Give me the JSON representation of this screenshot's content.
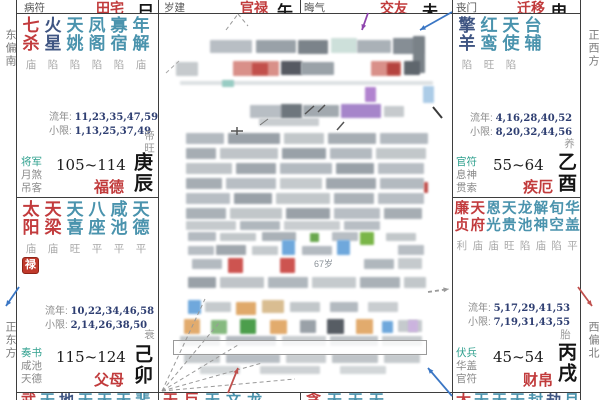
{
  "margins": {
    "left_top": "东偏南",
    "left_bottom": "正东方",
    "right_top": "正西方",
    "right_bottom": "西偏北"
  },
  "top_row": [
    {
      "god": "病符",
      "palace": "田宅",
      "branch": "巳"
    },
    {
      "god": "岁建",
      "palace": "官禄",
      "branch": "午"
    },
    {
      "god": "晦气",
      "palace": "交友",
      "branch": "未"
    },
    {
      "god": "丧门",
      "palace": "迁移",
      "branch": "申"
    }
  ],
  "palaces": {
    "fude": {
      "stars": [
        {
          "name": "七杀",
          "status": "庙",
          "type": "major"
        },
        {
          "name": "火星",
          "status": "陷",
          "type": "malefic"
        },
        {
          "name": "天姚",
          "status": "陷",
          "type": "minor"
        },
        {
          "name": "凤阁",
          "status": "陷",
          "type": "minor"
        },
        {
          "name": "寡宿",
          "status": "陷",
          "type": "minor"
        },
        {
          "name": "年解",
          "status": "庙",
          "type": "minor"
        }
      ],
      "liunian_label": "流年:",
      "liunian": "11,23,35,47,59",
      "xiaoxian_label": "小限:",
      "xiaoxian": "1,13,25,37,49",
      "stage": "帝旺",
      "gods": [
        "将军",
        "月煞",
        "吊客"
      ],
      "age_range": "105~114",
      "palace": "福德",
      "ganzhi": "庚辰"
    },
    "fumu": {
      "stars": [
        {
          "name": "太阳",
          "status": "庙",
          "type": "major"
        },
        {
          "name": "天梁",
          "status": "庙",
          "type": "major"
        },
        {
          "name": "天喜",
          "status": "旺",
          "type": "minor"
        },
        {
          "name": "八座",
          "status": "平",
          "type": "minor"
        },
        {
          "name": "咸池",
          "status": "平",
          "type": "minor"
        },
        {
          "name": "天德",
          "status": "平",
          "type": "minor"
        }
      ],
      "badge": "禄",
      "liunian_label": "流年:",
      "liunian": "10,22,34,46,58",
      "xiaoxian_label": "小限:",
      "xiaoxian": "2,14,26,38,50",
      "stage": "衰",
      "gods": [
        "奏书",
        "咸池",
        "天德"
      ],
      "age_range": "115~124",
      "palace": "父母",
      "ganzhi": "己卯"
    },
    "jie": {
      "stars": [
        {
          "name": "擎羊",
          "status": "陷",
          "type": "malefic"
        },
        {
          "name": "红鸾",
          "status": "旺",
          "type": "minor"
        },
        {
          "name": "天使",
          "status": "陷",
          "type": "minor"
        },
        {
          "name": "台辅",
          "status": "",
          "type": "minor"
        }
      ],
      "liunian_label": "流年:",
      "liunian": "4,16,28,40,52",
      "xiaoxian_label": "小限:",
      "xiaoxian": "8,20,32,44,56",
      "stage": "养",
      "gods": [
        "官符",
        "息神",
        "贯索"
      ],
      "age_range": "55~64",
      "palace": "疾厄",
      "ganzhi": "乙酉"
    },
    "caibo": {
      "stars": [
        {
          "name": "廉贞",
          "status": "利",
          "type": "major"
        },
        {
          "name": "天府",
          "status": "庙",
          "type": "major"
        },
        {
          "name": "恩光",
          "status": "庙",
          "type": "minor"
        },
        {
          "name": "天贵",
          "status": "旺",
          "type": "minor"
        },
        {
          "name": "龙池",
          "status": "陷",
          "type": "minor"
        },
        {
          "name": "解神",
          "status": "庙",
          "type": "minor"
        },
        {
          "name": "旬空",
          "status": "陷",
          "type": "minor"
        },
        {
          "name": "华盖",
          "status": "平",
          "type": "minor"
        }
      ],
      "liunian_label": "流年:",
      "liunian": "5,17,29,41,53",
      "xiaoxian_label": "小限:",
      "xiaoxian": "7,19,31,43,55",
      "stage": "胎",
      "gods": [
        "伏兵",
        "华盖",
        "官符"
      ],
      "age_range": "45~54",
      "palace": "财帛",
      "ganzhi": "丙戌"
    }
  },
  "bottom_row": [
    {
      "chars": [
        [
          "武",
          "major"
        ],
        [
          "天",
          "minor"
        ],
        [
          "地",
          "malefic"
        ],
        [
          "天",
          "minor"
        ],
        [
          "天",
          "minor"
        ],
        [
          "天",
          "minor"
        ],
        [
          "蜚",
          "minor"
        ]
      ]
    },
    {
      "chars": [
        [
          "天",
          "major"
        ],
        [
          "巨",
          "major"
        ],
        [
          "天",
          "minor"
        ],
        [
          "文",
          "minor"
        ],
        [
          "龙",
          "minor"
        ]
      ]
    },
    {
      "chars": [
        [
          "贪",
          "major"
        ],
        [
          "天",
          "minor"
        ],
        [
          "天",
          "minor"
        ],
        [
          "天",
          "minor"
        ]
      ]
    },
    {
      "chars": [
        [
          "太",
          "major"
        ],
        [
          "天",
          "minor"
        ],
        [
          "天",
          "minor"
        ],
        [
          "天",
          "minor"
        ],
        [
          "封",
          "minor"
        ],
        [
          "劫",
          "malefic"
        ],
        [
          "月",
          "minor"
        ]
      ]
    }
  ],
  "colors": {
    "major": "#c23b3d",
    "malefic": "#3f5582",
    "minor": "#4a93ad",
    "status": "#a8a8a8",
    "palace_name": "#c13b3c",
    "badge_bg": "#c0392b",
    "arrow_blue": "#3a76c4",
    "arrow_red": "#c0504d",
    "arrow_purple": "#8e44ad"
  },
  "center": {
    "texts": [
      {
        "x": 314,
        "y": 257,
        "t": "67岁"
      }
    ],
    "outline_box": {
      "x": 173,
      "y": 340,
      "w": 252,
      "h": 13
    },
    "blocks": [
      [
        210,
        40,
        42,
        13,
        "#b8bec4"
      ],
      [
        256,
        40,
        40,
        13,
        "#99a1a8"
      ],
      [
        298,
        40,
        30,
        14,
        "#7b838a"
      ],
      [
        331,
        38,
        26,
        15,
        "#cde0da"
      ],
      [
        357,
        40,
        34,
        13,
        "#aab1b7"
      ],
      [
        393,
        38,
        30,
        16,
        "#868e95"
      ],
      [
        413,
        36,
        12,
        37,
        "#7a8288"
      ],
      [
        176,
        62,
        22,
        14,
        "#c6cacd"
      ],
      [
        233,
        61,
        46,
        15,
        "#d99089"
      ],
      [
        252,
        63,
        16,
        12,
        "#c2504b"
      ],
      [
        281,
        61,
        21,
        14,
        "#565a62"
      ],
      [
        301,
        62,
        33,
        13,
        "#9aa2a8"
      ],
      [
        371,
        61,
        30,
        15,
        "#d99089"
      ],
      [
        387,
        63,
        13,
        12,
        "#b5443f"
      ],
      [
        404,
        61,
        16,
        14,
        "#5f666d"
      ],
      [
        180,
        81,
        253,
        4,
        "#dde1e3"
      ],
      [
        222,
        80,
        12,
        7,
        "#98ccc3"
      ],
      [
        365,
        87,
        11,
        15,
        "#b183cf"
      ],
      [
        423,
        86,
        11,
        17,
        "#accce7"
      ],
      [
        250,
        105,
        32,
        13,
        "#b8bec4"
      ],
      [
        281,
        104,
        21,
        15,
        "#6e767d"
      ],
      [
        303,
        105,
        36,
        12,
        "#a2a9af"
      ],
      [
        341,
        104,
        40,
        14,
        "#a685ca"
      ],
      [
        384,
        106,
        20,
        11,
        "#c6cacd"
      ],
      [
        259,
        118,
        60,
        8,
        "#c9cdd0"
      ],
      [
        186,
        133,
        38,
        11,
        "#b3bac0"
      ],
      [
        228,
        133,
        52,
        11,
        "#9aa1a8"
      ],
      [
        284,
        133,
        40,
        11,
        "#c2c7ca"
      ],
      [
        328,
        133,
        48,
        11,
        "#a6adb3"
      ],
      [
        380,
        133,
        48,
        11,
        "#b3bac0"
      ],
      [
        186,
        148,
        30,
        11,
        "#a6adb3"
      ],
      [
        220,
        148,
        58,
        11,
        "#bfc4c8"
      ],
      [
        282,
        148,
        44,
        11,
        "#99a1a8"
      ],
      [
        330,
        148,
        42,
        11,
        "#b3bac0"
      ],
      [
        376,
        148,
        50,
        11,
        "#c2c7ca"
      ],
      [
        186,
        163,
        46,
        11,
        "#bfc4c8"
      ],
      [
        236,
        163,
        40,
        11,
        "#a0a7ae"
      ],
      [
        280,
        163,
        52,
        11,
        "#b3bac0"
      ],
      [
        336,
        163,
        38,
        11,
        "#99a1a8"
      ],
      [
        378,
        163,
        46,
        11,
        "#b8bec4"
      ],
      [
        186,
        178,
        36,
        11,
        "#a6adb3"
      ],
      [
        226,
        178,
        50,
        11,
        "#b8bec4"
      ],
      [
        280,
        178,
        42,
        11,
        "#c5cacd"
      ],
      [
        326,
        178,
        50,
        11,
        "#a0a7ae"
      ],
      [
        380,
        178,
        44,
        11,
        "#b3bac0"
      ],
      [
        186,
        193,
        44,
        11,
        "#b8bec4"
      ],
      [
        234,
        193,
        38,
        11,
        "#9aa1a8"
      ],
      [
        276,
        193,
        54,
        11,
        "#c2c7ca"
      ],
      [
        334,
        193,
        40,
        11,
        "#abb2b8"
      ],
      [
        378,
        193,
        46,
        11,
        "#b8bec4"
      ],
      [
        186,
        208,
        40,
        11,
        "#aab1b7"
      ],
      [
        230,
        208,
        52,
        11,
        "#c2c7ca"
      ],
      [
        286,
        208,
        44,
        11,
        "#9aa1a8"
      ],
      [
        334,
        208,
        46,
        11,
        "#b8bec4"
      ],
      [
        384,
        208,
        38,
        11,
        "#a6adb3"
      ],
      [
        186,
        221,
        50,
        9,
        "#c5cacd"
      ],
      [
        240,
        221,
        40,
        9,
        "#b0b7bd"
      ],
      [
        284,
        221,
        56,
        9,
        "#c9cdd0"
      ],
      [
        344,
        221,
        36,
        9,
        "#b8bec4"
      ],
      [
        188,
        232,
        28,
        9,
        "#b3bac0"
      ],
      [
        220,
        233,
        36,
        8,
        "#c2c7ca"
      ],
      [
        262,
        232,
        34,
        9,
        "#aab1b7"
      ],
      [
        310,
        233,
        9,
        9,
        "#6aa84f"
      ],
      [
        332,
        232,
        26,
        9,
        "#b8bec4"
      ],
      [
        360,
        232,
        14,
        13,
        "#7ab648"
      ],
      [
        386,
        233,
        30,
        8,
        "#c2c7ca"
      ],
      [
        282,
        240,
        13,
        15,
        "#6fa8dc"
      ],
      [
        337,
        240,
        13,
        15,
        "#6fa8dc"
      ],
      [
        188,
        246,
        26,
        9,
        "#b8bec4"
      ],
      [
        216,
        245,
        30,
        10,
        "#a0a7ae"
      ],
      [
        252,
        246,
        26,
        9,
        "#c5cacd"
      ],
      [
        302,
        246,
        30,
        9,
        "#b3bac0"
      ],
      [
        398,
        245,
        26,
        10,
        "#b8bec4"
      ],
      [
        228,
        258,
        15,
        15,
        "#cd5450"
      ],
      [
        280,
        258,
        15,
        15,
        "#cd5450"
      ],
      [
        192,
        259,
        30,
        10,
        "#b3bac0"
      ],
      [
        364,
        259,
        30,
        10,
        "#b0b7bd"
      ],
      [
        398,
        258,
        24,
        11,
        "#c5cacd"
      ],
      [
        188,
        277,
        28,
        11,
        "#9aa1a8"
      ],
      [
        220,
        277,
        44,
        11,
        "#bfc4c8"
      ],
      [
        268,
        277,
        40,
        11,
        "#b0b7bd"
      ],
      [
        312,
        277,
        44,
        11,
        "#c5cacd"
      ],
      [
        360,
        277,
        40,
        11,
        "#aab1b7"
      ],
      [
        404,
        277,
        22,
        11,
        "#c2c7ca"
      ],
      [
        188,
        300,
        13,
        14,
        "#6fa8dc"
      ],
      [
        236,
        302,
        20,
        13,
        "#e0a96a"
      ],
      [
        262,
        300,
        22,
        13,
        "#d9bd91"
      ],
      [
        205,
        302,
        26,
        10,
        "#c5cacd"
      ],
      [
        290,
        302,
        30,
        10,
        "#c2c7ca"
      ],
      [
        330,
        302,
        28,
        10,
        "#b3bac0"
      ],
      [
        368,
        302,
        30,
        10,
        "#c9cdd0"
      ],
      [
        184,
        319,
        16,
        15,
        "#e2ab6d"
      ],
      [
        211,
        320,
        16,
        14,
        "#86b97f"
      ],
      [
        240,
        319,
        16,
        15,
        "#4c9e4c"
      ],
      [
        270,
        320,
        17,
        14,
        "#e2ab6d"
      ],
      [
        300,
        320,
        16,
        13,
        "#9aa1a8"
      ],
      [
        327,
        319,
        17,
        15,
        "#575d64"
      ],
      [
        356,
        319,
        17,
        15,
        "#e2ab6d"
      ],
      [
        382,
        321,
        11,
        12,
        "#6fa8dc"
      ],
      [
        398,
        320,
        24,
        12,
        "#c5cacd"
      ],
      [
        408,
        320,
        10,
        12,
        "#cbb3de"
      ],
      [
        180,
        336,
        40,
        10,
        "#c2c7ca"
      ],
      [
        226,
        336,
        50,
        10,
        "#b3bac0"
      ],
      [
        282,
        336,
        44,
        10,
        "#c9cdd0"
      ],
      [
        330,
        336,
        48,
        10,
        "#bfc4c8"
      ],
      [
        382,
        336,
        40,
        10,
        "#c5cacd"
      ],
      [
        184,
        354,
        36,
        9,
        "#c5cacd"
      ],
      [
        226,
        354,
        54,
        9,
        "#b8bec4"
      ],
      [
        286,
        354,
        40,
        9,
        "#c9cdd0"
      ],
      [
        332,
        354,
        46,
        9,
        "#bfc4c8"
      ],
      [
        384,
        354,
        36,
        9,
        "#c5cacd"
      ],
      [
        200,
        366,
        40,
        8,
        "#d2d6d8"
      ],
      [
        260,
        366,
        60,
        8,
        "#cdd1d4"
      ],
      [
        340,
        366,
        46,
        8,
        "#d2d6d8"
      ],
      [
        424,
        182,
        4,
        11,
        "#c0504d"
      ]
    ],
    "lines": [
      [
        433,
        107,
        442,
        118,
        "#3a3a3a",
        2
      ],
      [
        305,
        114,
        314,
        106,
        "#555555",
        1.5
      ],
      [
        318,
        112,
        325,
        105,
        "#555555",
        1.5
      ],
      [
        337,
        130,
        344,
        122,
        "#555555",
        1.5
      ],
      [
        231,
        131,
        243,
        131,
        "#555555",
        1.5
      ],
      [
        237,
        127,
        237,
        135,
        "#555555",
        1.5
      ],
      [
        260,
        125,
        268,
        119,
        "#777777",
        1
      ]
    ],
    "dashes": [
      [
        226,
        30,
        238,
        14,
        "#999999"
      ],
      [
        238,
        14,
        248,
        26,
        "#999999"
      ],
      [
        166,
        73,
        179,
        61,
        "#aaaaaa"
      ],
      [
        162,
        391,
        205,
        299,
        "#999999"
      ],
      [
        162,
        391,
        219,
        323,
        "#999999"
      ],
      [
        162,
        391,
        238,
        345,
        "#999999"
      ],
      [
        162,
        391,
        262,
        363,
        "#999999"
      ],
      [
        162,
        391,
        295,
        379,
        "#999999"
      ]
    ],
    "arrows": [
      {
        "x1": 368,
        "y1": 13,
        "x2": 362,
        "y2": 30,
        "c": "#8e44ad"
      },
      {
        "x1": 452,
        "y1": 12,
        "x2": 420,
        "y2": 30,
        "c": "#3a76c4"
      },
      {
        "x1": 228,
        "y1": 393,
        "x2": 238,
        "y2": 368,
        "c": "#c0504d"
      },
      {
        "x1": 452,
        "y1": 396,
        "x2": 428,
        "y2": 368,
        "c": "#3a76c4"
      },
      {
        "x1": 19,
        "y1": 287,
        "x2": 6,
        "y2": 306,
        "c": "#3a76c4"
      },
      {
        "x1": 578,
        "y1": 287,
        "x2": 592,
        "y2": 306,
        "c": "#c0504d"
      },
      {
        "x1": 428,
        "y1": 292,
        "x2": 449,
        "y2": 289,
        "c": "#9a9a9a",
        "dash": true
      }
    ]
  }
}
